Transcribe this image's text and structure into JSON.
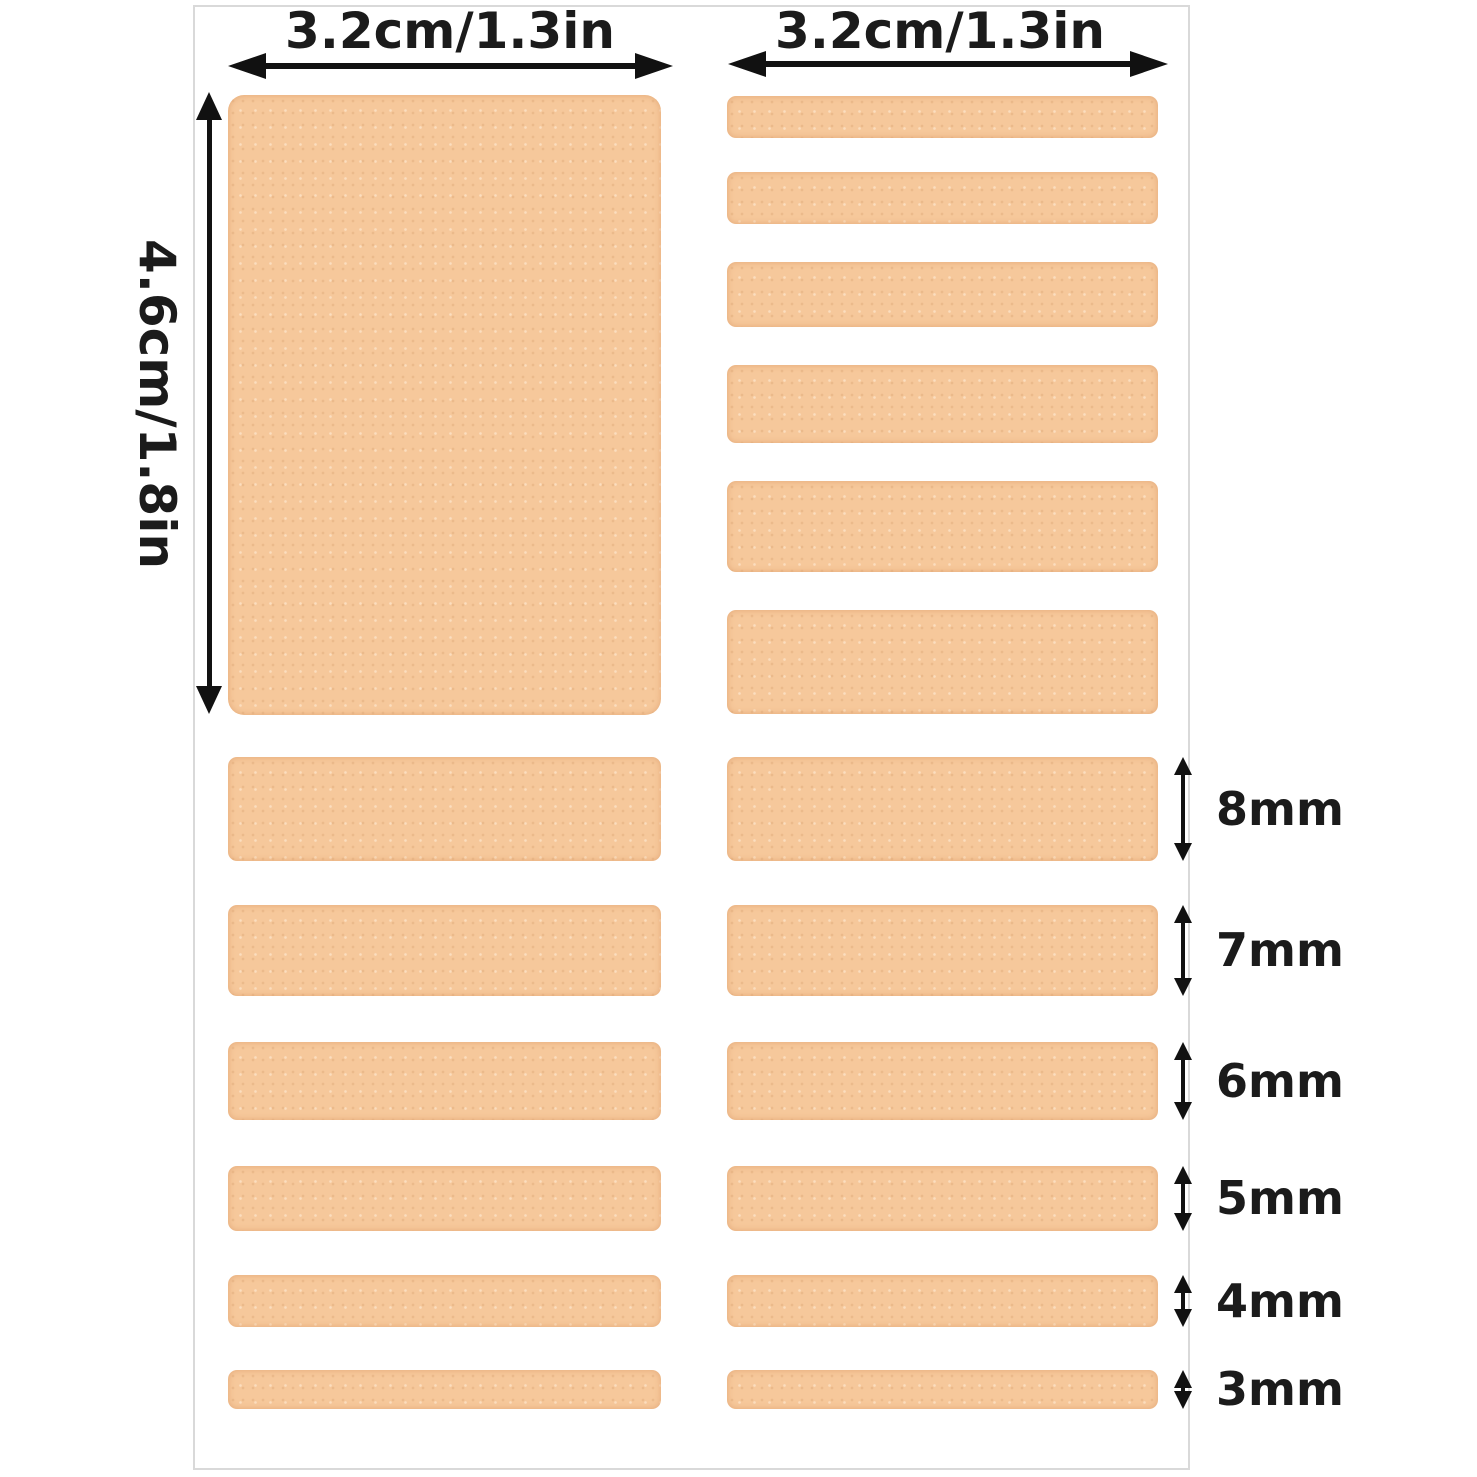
{
  "diagram": {
    "top_width_label_left": "3.2cm/1.3in",
    "top_width_label_right": "3.2cm/1.3in",
    "side_height_label": "4.6cm/1.8in",
    "thickness_labels": [
      "8mm",
      "7mm",
      "6mm",
      "5mm",
      "4mm",
      "3mm"
    ]
  },
  "colors": {
    "foam": "#f6c89b",
    "foam-edge": "#e3a877",
    "arrow": "#111111",
    "text": "#1b1b1b",
    "panel-border": "#d9d9d9",
    "background": "#ffffff"
  }
}
